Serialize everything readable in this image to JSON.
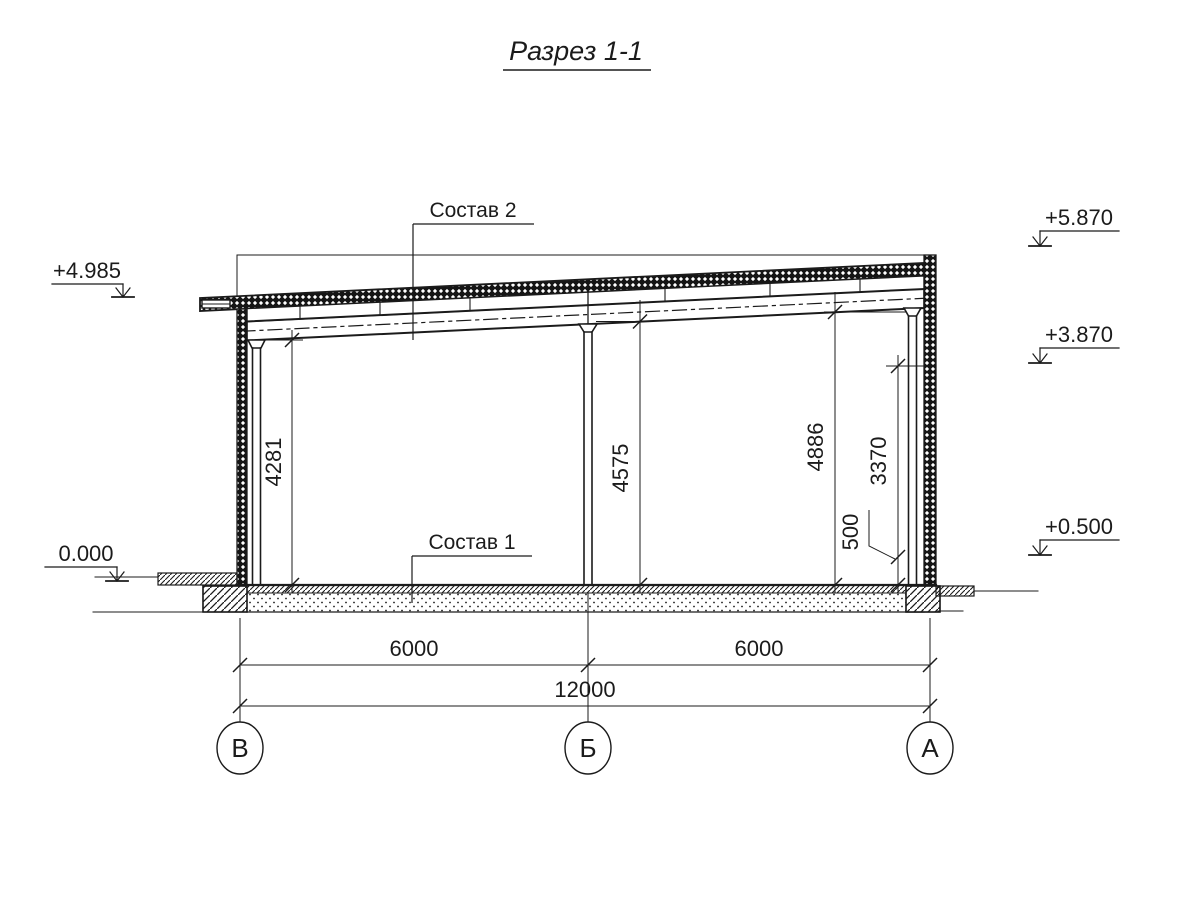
{
  "title": "Разрез 1-1",
  "callouts": {
    "roof": "Состав 2",
    "floor": "Состав 1"
  },
  "elevations": {
    "left_top": "+4.985",
    "left_zero": "0.000",
    "right_top": "+5.870",
    "right_mid": "+3.870",
    "right_low": "+0.500"
  },
  "dims": {
    "v_left": "4281",
    "v_middle": "4575",
    "v_right": "4886",
    "v_wall": "3370",
    "v_plinth": "500",
    "span_left": "6000",
    "span_right": "6000",
    "total": "12000"
  },
  "axes": [
    "В",
    "Б",
    "А"
  ],
  "colors": {
    "ink": "#1b1b1b",
    "background": "#ffffff"
  }
}
